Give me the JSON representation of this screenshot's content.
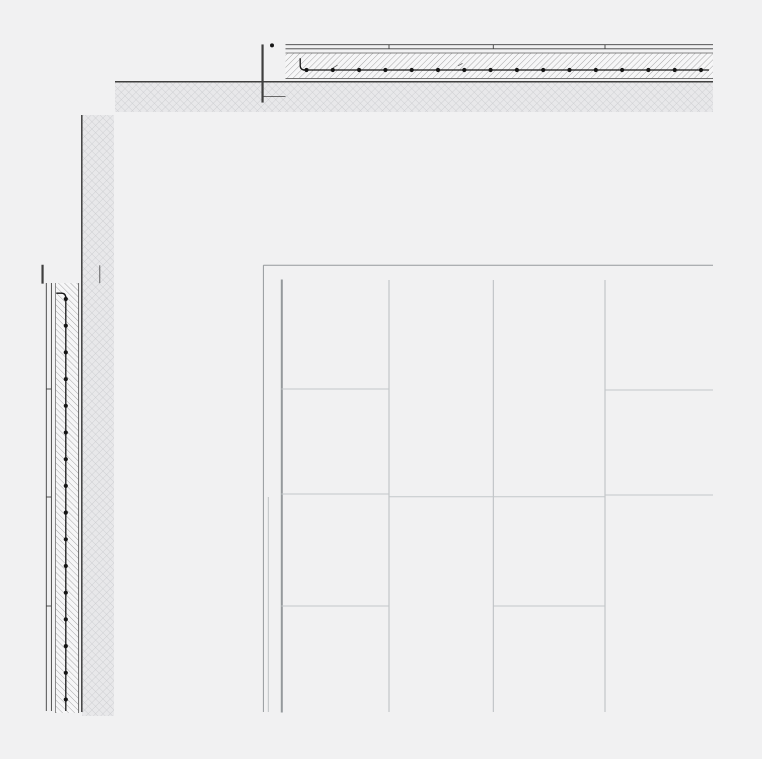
{
  "canvas": {
    "width": 762,
    "height": 759,
    "background": "#f1f1f2"
  },
  "palette": {
    "bg": "#f1f1f2",
    "paper": "#f4f4f5",
    "white": "#f7f7f8",
    "dark": "#3f3f3f",
    "medium": "#5f5f5f",
    "rebar": "#161616",
    "hatch": "#8f8f8f",
    "ground_base": "#e8e8ea",
    "ground_line": "#c9cbce",
    "frame": "#95999c",
    "grid": "#b9bdc0",
    "joint": "#c3c7c9"
  },
  "panel_grid_summary": {
    "columns_x": [
      281.3,
      389,
      493.3,
      605,
      713
    ],
    "rows_top": 280,
    "rows_bottom": 712,
    "joints_by_column": [
      [
        389,
        494,
        606
      ],
      [
        496.8
      ],
      [
        496.8,
        606
      ],
      [
        390,
        495
      ]
    ]
  },
  "elements": [
    {
      "type": "rect",
      "name": "ground-band-horizontal",
      "x": 115,
      "y": 82.3,
      "w": 598,
      "h": 29.7,
      "fill": "pattern:cross"
    },
    {
      "type": "rect",
      "name": "ground-band-vertical",
      "x": 82,
      "y": 115,
      "w": 32,
      "h": 601,
      "fill": "pattern:cross"
    },
    {
      "type": "line",
      "name": "ground-edge-top",
      "x1": 115,
      "y1": 81.8,
      "x2": 713,
      "y2": 81.8,
      "stroke": "dark",
      "w": 1.5
    },
    {
      "type": "line",
      "name": "ground-edge-left",
      "x1": 81.8,
      "y1": 115,
      "x2": 81.8,
      "y2": 712,
      "stroke": "dark",
      "w": 1.5
    },
    {
      "type": "line",
      "name": "slab-finish-line-outer",
      "x1": 285.5,
      "y1": 44.7,
      "x2": 713,
      "y2": 44.7,
      "stroke": "dark",
      "w": 0.9
    },
    {
      "type": "line",
      "name": "slab-finish-line-inner",
      "x1": 285.5,
      "y1": 48.8,
      "x2": 713,
      "y2": 48.8,
      "stroke": "dark",
      "w": 0.9
    },
    {
      "type": "lines",
      "name": "slab-finish-joint-tick",
      "segs": [
        [
          389,
          44.7,
          389,
          48.8
        ],
        [
          493.3,
          44.7,
          493.3,
          48.8
        ],
        [
          605,
          44.7,
          605,
          48.8
        ]
      ],
      "stroke": "dark",
      "w": 0.9
    },
    {
      "type": "rect",
      "name": "slab-concrete-hatch",
      "x": 285.5,
      "y": 53,
      "w": 427.5,
      "h": 25.6,
      "fill": "pattern:hatch-up"
    },
    {
      "type": "line",
      "name": "slab-hatch-top-edge",
      "x1": 285.5,
      "y1": 53,
      "x2": 713,
      "y2": 53,
      "stroke": "medium",
      "w": 0.7
    },
    {
      "type": "line",
      "name": "slab-soffit-edge",
      "x1": 285.5,
      "y1": 78.6,
      "x2": 713,
      "y2": 78.6,
      "stroke": "medium",
      "w": 0.9
    },
    {
      "type": "path",
      "name": "slab-rebar-hook",
      "d": "M 300.2 58.3 L 300.2 65.5 Q 300.2 70 305 70",
      "stroke": "rebar",
      "w": 1.3
    },
    {
      "type": "line",
      "name": "slab-rebar-bar",
      "x1": 303,
      "y1": 70,
      "x2": 709,
      "y2": 70,
      "stroke": "rebar",
      "w": 1.3
    },
    {
      "type": "dots",
      "name": "slab-rebar-dot",
      "axis": "x",
      "fixed": 70,
      "start": 306.5,
      "step": 26.3,
      "count": 16,
      "r": 2.1,
      "fill": "rebar"
    },
    {
      "type": "lines",
      "name": "slab-bar-spacing-mark",
      "segs": [
        [
          333,
          67.8,
          337.5,
          65.2
        ],
        [
          458,
          65.8,
          462.5,
          63.4
        ]
      ],
      "stroke": "medium",
      "w": 0.8
    },
    {
      "type": "rect",
      "name": "parapet-block",
      "x": 262,
      "y": 45,
      "w": 1.1,
      "h": 57,
      "fill": "white",
      "stroke": "dark"
    },
    {
      "type": "line",
      "name": "parapet-block-joint-line",
      "x1": 262,
      "y1": 96.6,
      "x2": 285.5,
      "y2": 96.6,
      "stroke": "dark",
      "w": 0.8
    },
    {
      "type": "circle",
      "name": "parapet-rebar-dot",
      "cx": 272,
      "cy": 45.4,
      "r": 2,
      "fill": "rebar"
    },
    {
      "type": "line",
      "name": "wall-finish-line-outer",
      "x1": 46.3,
      "y1": 283,
      "x2": 46.3,
      "y2": 711,
      "stroke": "dark",
      "w": 0.9
    },
    {
      "type": "line",
      "name": "wall-finish-line-inner",
      "x1": 51.4,
      "y1": 283,
      "x2": 51.4,
      "y2": 711,
      "stroke": "dark",
      "w": 0.9
    },
    {
      "type": "lines",
      "name": "wall-finish-joint-tick",
      "segs": [
        [
          46.3,
          389,
          51.4,
          389
        ],
        [
          46.3,
          497,
          51.4,
          497
        ],
        [
          46.3,
          606,
          51.4,
          606
        ]
      ],
      "stroke": "dark",
      "w": 0.9
    },
    {
      "type": "rect",
      "name": "wall-concrete-hatch",
      "x": 55.5,
      "y": 283,
      "w": 23.1,
      "h": 430,
      "fill": "pattern:hatch-down"
    },
    {
      "type": "line",
      "name": "wall-hatch-left-edge",
      "x1": 55.5,
      "y1": 283,
      "x2": 55.5,
      "y2": 713,
      "stroke": "medium",
      "w": 0.7
    },
    {
      "type": "line",
      "name": "wall-soffit-edge",
      "x1": 78.6,
      "y1": 283,
      "x2": 78.6,
      "y2": 713,
      "stroke": "medium",
      "w": 0.9
    },
    {
      "type": "path",
      "name": "wall-rebar-hook",
      "d": "M 56.3 293.2 L 61.5 293.2 Q 65.8 293.2 65.8 298",
      "stroke": "rebar",
      "w": 1.3
    },
    {
      "type": "line",
      "name": "wall-rebar-bar",
      "x1": 65.8,
      "y1": 296,
      "x2": 65.8,
      "y2": 711,
      "stroke": "rebar",
      "w": 1.3
    },
    {
      "type": "dots",
      "name": "wall-rebar-dot",
      "axis": "y",
      "fixed": 65.8,
      "start": 299,
      "step": 26.7,
      "count": 16,
      "r": 2.1,
      "fill": "rebar"
    },
    {
      "type": "rect",
      "name": "wall-cap-block",
      "x": 42,
      "y": 265.3,
      "w": 1.1,
      "h": 17.8,
      "fill": "white",
      "stroke": "dark"
    },
    {
      "type": "line",
      "name": "wall-cap-joint-line",
      "x1": 99.8,
      "y1": 265.3,
      "x2": 99.8,
      "y2": 283.1,
      "stroke": "dark",
      "w": 0.8
    },
    {
      "type": "rect",
      "name": "panel-field",
      "x": 281.3,
      "y": 280,
      "w": 1,
      "h": 432,
      "fill": "paper",
      "stroke": "frame"
    },
    {
      "type": "line",
      "name": "panel-outer-frame-top",
      "x1": 263.4,
      "y1": 265.3,
      "x2": 713,
      "y2": 265.3,
      "stroke": "frame",
      "w": 1
    },
    {
      "type": "line",
      "name": "panel-outer-frame-left",
      "x1": 263.4,
      "y1": 265.3,
      "x2": 263.4,
      "y2": 712,
      "stroke": "frame",
      "w": 1
    },
    {
      "type": "line",
      "name": "panel-outer-frame-left-joint",
      "x1": 268.3,
      "y1": 497,
      "x2": 268.3,
      "y2": 712,
      "stroke": "grid",
      "w": 0.9
    },
    {
      "type": "lines",
      "name": "panel-column-line",
      "segs": [
        [
          389,
          280,
          389,
          712
        ],
        [
          493.3,
          280,
          493.3,
          712
        ],
        [
          605,
          280,
          605,
          712
        ]
      ],
      "stroke": "grid",
      "w": 1
    },
    {
      "type": "lines",
      "name": "panel-joint-line",
      "segs": [
        [
          281.3,
          389,
          389,
          389
        ],
        [
          281.3,
          494,
          389,
          494
        ],
        [
          281.3,
          606,
          389,
          606
        ],
        [
          389,
          496.8,
          493.3,
          496.8
        ],
        [
          493.3,
          496.8,
          605,
          496.8
        ],
        [
          493.3,
          606,
          605,
          606
        ],
        [
          605,
          390,
          713,
          390
        ],
        [
          605,
          495,
          713,
          495
        ]
      ],
      "stroke": "joint",
      "w": 1
    }
  ]
}
